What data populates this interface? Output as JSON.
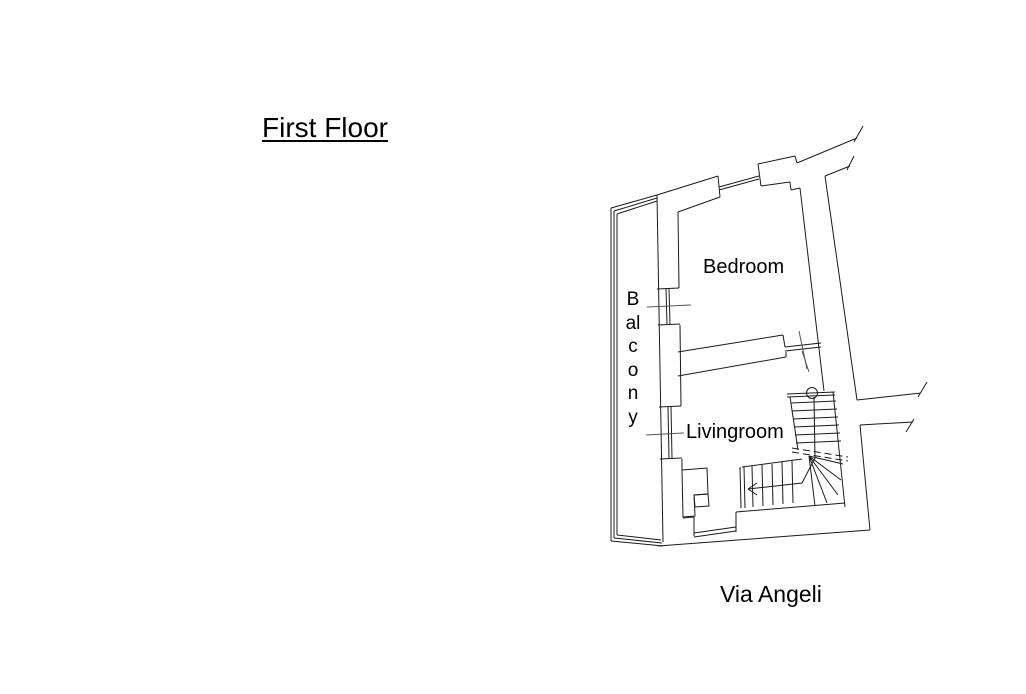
{
  "title": {
    "text": "First Floor"
  },
  "street": {
    "text": "Via Angeli"
  },
  "rooms": {
    "bedroom": "Bedroom",
    "livingroom": "Livingroom",
    "balcony": "Balcony"
  },
  "drawing": {
    "background": "#ffffff",
    "wall_line_color": "#1a1a1a",
    "tick_line_color": "#555555",
    "elements": [
      "balcony-railing",
      "balcony-windows",
      "bedroom-window",
      "interior-divider-wall",
      "door-opening-ticks",
      "winder-staircase",
      "stair-direction-arrow",
      "stair-newel-circle",
      "section-cut-dashed-lines",
      "wall-break-marks",
      "entrance-threshold"
    ]
  }
}
